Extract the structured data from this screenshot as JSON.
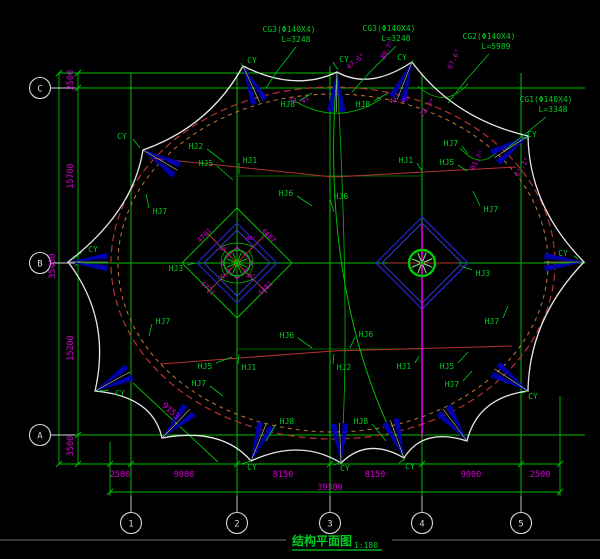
{
  "title": {
    "text": "结构平面图",
    "scale": "1:180"
  },
  "colors": {
    "grid_green": "#00bf00",
    "label_green": "#00cc22",
    "dim_magenta": "#d400d4",
    "outline_white": "#e8e8e8",
    "fan_blue": "#0000b0",
    "cable_red": "#b43232",
    "cable_orange": "#c87830",
    "mast_magenta": "#ff00ff",
    "bubble_grey": "#d8d8d8"
  },
  "grid": {
    "cols": [
      {
        "label": "1",
        "x": 131
      },
      {
        "label": "2",
        "x": 237
      },
      {
        "label": "3",
        "x": 330
      },
      {
        "label": "4",
        "x": 422
      },
      {
        "label": "5",
        "x": 521
      }
    ],
    "rows": [
      {
        "label": "C",
        "y": 88
      },
      {
        "label": "B",
        "y": 263
      },
      {
        "label": "A",
        "y": 435
      }
    ]
  },
  "dims": {
    "bottom_chain": [
      {
        "t": "2500",
        "x": 120,
        "y": 474
      },
      {
        "t": "9000",
        "x": 184,
        "y": 474
      },
      {
        "t": "8150",
        "x": 283,
        "y": 474
      },
      {
        "t": "8150",
        "x": 375,
        "y": 474
      },
      {
        "t": "9000",
        "x": 471,
        "y": 474
      },
      {
        "t": "2500",
        "x": 540,
        "y": 474
      }
    ],
    "bottom_total": {
      "t": "39300",
      "x": 330,
      "y": 488
    },
    "left_chain": [
      {
        "t": "2500",
        "x": 73,
        "y": 80
      },
      {
        "t": "15700",
        "x": 73,
        "y": 176
      },
      {
        "t": "15200",
        "x": 73,
        "y": 348
      },
      {
        "t": "3500",
        "x": 73,
        "y": 446
      }
    ],
    "left_total": {
      "t": "35400",
      "x": 55,
      "y": 266
    },
    "diagonal": {
      "t": "9153",
      "x": 169,
      "y": 413,
      "r": 43
    }
  },
  "notes": [
    {
      "line1": "CG3(Φ140X4)",
      "line2": "L=3248",
      "x": 289,
      "y": 32,
      "leader": [
        296,
        47,
        278,
        70,
        266,
        88
      ]
    },
    {
      "line1": "CG3(Φ140X4)",
      "line2": "L=3248",
      "x": 389,
      "y": 31,
      "leader": [
        396,
        46,
        370,
        72,
        352,
        92
      ]
    },
    {
      "line1": "CG2(Φ140X4)",
      "line2": "L=5989",
      "x": 489,
      "y": 39,
      "leader": [
        489,
        54,
        466,
        80,
        448,
        103
      ]
    },
    {
      "line1": "CG1(Φ140X4)",
      "line2": "L=3348",
      "x": 546,
      "y": 102,
      "leader": [
        546,
        117,
        524,
        135,
        505,
        150
      ]
    }
  ],
  "member_labels": [
    {
      "t": "HJ8",
      "x": 288,
      "y": 104,
      "ex": 312,
      "ey": 93
    },
    {
      "t": "HJ8",
      "x": 363,
      "y": 104,
      "ex": 388,
      "ey": 93
    },
    {
      "t": "HJ2",
      "x": 196,
      "y": 146,
      "ex": 224,
      "ey": 162
    },
    {
      "t": "HJ5",
      "x": 206,
      "y": 163,
      "ex": 233,
      "ey": 180
    },
    {
      "t": "HJ1",
      "x": 250,
      "y": 160,
      "ex": 239,
      "ey": 174
    },
    {
      "t": "HJ7",
      "x": 160,
      "y": 211,
      "ex": 146,
      "ey": 194
    },
    {
      "t": "HJ6",
      "x": 286,
      "y": 193,
      "ex": 312,
      "ey": 206
    },
    {
      "t": "HJ6",
      "x": 341,
      "y": 196,
      "ex": 334,
      "ey": 212
    },
    {
      "t": "HJ1",
      "x": 406,
      "y": 160,
      "ex": 422,
      "ey": 171
    },
    {
      "t": "HJ7",
      "x": 451,
      "y": 143,
      "ex": 468,
      "ey": 154
    },
    {
      "t": "HJ5",
      "x": 447,
      "y": 162,
      "ex": 467,
      "ey": 171
    },
    {
      "t": "HJ7",
      "x": 491,
      "y": 209,
      "ex": 473,
      "ey": 191
    },
    {
      "t": "HJ3",
      "x": 176,
      "y": 268,
      "ex": 196,
      "ey": 263
    },
    {
      "t": "HJ3",
      "x": 483,
      "y": 273,
      "ex": 461,
      "ey": 266
    },
    {
      "t": "HJ7",
      "x": 163,
      "y": 321,
      "ex": 149,
      "ey": 336
    },
    {
      "t": "HJ6",
      "x": 287,
      "y": 335,
      "ex": 312,
      "ey": 348
    },
    {
      "t": "HJ6",
      "x": 366,
      "y": 334,
      "ex": 350,
      "ey": 348
    },
    {
      "t": "HJ5",
      "x": 205,
      "y": 366,
      "ex": 232,
      "ey": 357
    },
    {
      "t": "HJ7",
      "x": 199,
      "y": 383,
      "ex": 223,
      "ey": 396
    },
    {
      "t": "HJ1",
      "x": 249,
      "y": 367,
      "ex": 239,
      "ey": 354
    },
    {
      "t": "HJ2",
      "x": 344,
      "y": 367,
      "ex": 334,
      "ey": 354
    },
    {
      "t": "HJ8",
      "x": 287,
      "y": 421,
      "ex": 266,
      "ey": 441
    },
    {
      "t": "HJ8",
      "x": 361,
      "y": 421,
      "ex": 386,
      "ey": 441
    },
    {
      "t": "HJ1",
      "x": 404,
      "y": 366,
      "ex": 419,
      "ey": 356
    },
    {
      "t": "HJ5",
      "x": 447,
      "y": 366,
      "ex": 468,
      "ey": 352
    },
    {
      "t": "HJ7",
      "x": 452,
      "y": 384,
      "ex": 472,
      "ey": 371
    },
    {
      "t": "HJ7",
      "x": 492,
      "y": 321,
      "ex": 508,
      "ey": 306
    }
  ],
  "cy_labels": [
    {
      "t": "CY",
      "x": 252,
      "y": 60,
      "ex": 243,
      "ey": 67
    },
    {
      "t": "CY",
      "x": 344,
      "y": 59,
      "ex": 338,
      "ey": 70
    },
    {
      "t": "CY",
      "x": 402,
      "y": 57,
      "ex": 411,
      "ey": 64
    },
    {
      "t": "CY",
      "x": 532,
      "y": 134,
      "ex": 527,
      "ey": 139
    },
    {
      "t": "CY",
      "x": 563,
      "y": 253,
      "ex": 578,
      "ey": 259
    },
    {
      "t": "CY",
      "x": 533,
      "y": 396,
      "ex": 528,
      "ey": 391
    },
    {
      "t": "CY",
      "x": 122,
      "y": 136,
      "ex": 140,
      "ey": 148
    },
    {
      "t": "CY",
      "x": 93,
      "y": 249,
      "ex": 73,
      "ey": 259
    },
    {
      "t": "CY",
      "x": 120,
      "y": 393,
      "ex": 98,
      "ey": 391
    },
    {
      "t": "CY",
      "x": 252,
      "y": 467,
      "ex": 251,
      "ey": 461
    },
    {
      "t": "CY",
      "x": 345,
      "y": 468,
      "ex": 341,
      "ey": 462
    },
    {
      "t": "CY",
      "x": 410,
      "y": 466,
      "ex": 405,
      "ey": 459
    }
  ],
  "angle_labels": [
    {
      "t": "42.4°",
      "x": 299,
      "y": 103,
      "r": 0
    },
    {
      "t": "47.4°",
      "x": 399,
      "y": 103,
      "r": 0
    },
    {
      "t": "47.6°",
      "x": 357,
      "y": 63,
      "r": -38
    },
    {
      "t": "39.7°",
      "x": 389,
      "y": 51,
      "r": -62
    },
    {
      "t": "22.3°",
      "x": 429,
      "y": 109,
      "r": -50
    },
    {
      "t": "67.6°",
      "x": 456,
      "y": 60,
      "r": -65
    },
    {
      "t": "61.7°",
      "x": 479,
      "y": 161,
      "r": -62
    },
    {
      "t": "61.1°",
      "x": 524,
      "y": 168,
      "r": -58
    }
  ],
  "mast_edge_dims": [
    {
      "t": "4701",
      "x": 206,
      "y": 237,
      "r": -45
    },
    {
      "t": "4487",
      "x": 267,
      "y": 237,
      "r": 45
    },
    {
      "t": "4771",
      "x": 206,
      "y": 290,
      "r": 45
    },
    {
      "t": "4481",
      "x": 267,
      "y": 290,
      "r": -45
    }
  ],
  "mast_inner_angles": [
    {
      "t": "43°",
      "x": 224,
      "y": 251
    },
    {
      "t": "46°",
      "x": 251,
      "y": 240
    },
    {
      "t": "47°",
      "x": 251,
      "y": 278
    },
    {
      "t": "42°",
      "x": 224,
      "y": 278
    }
  ]
}
